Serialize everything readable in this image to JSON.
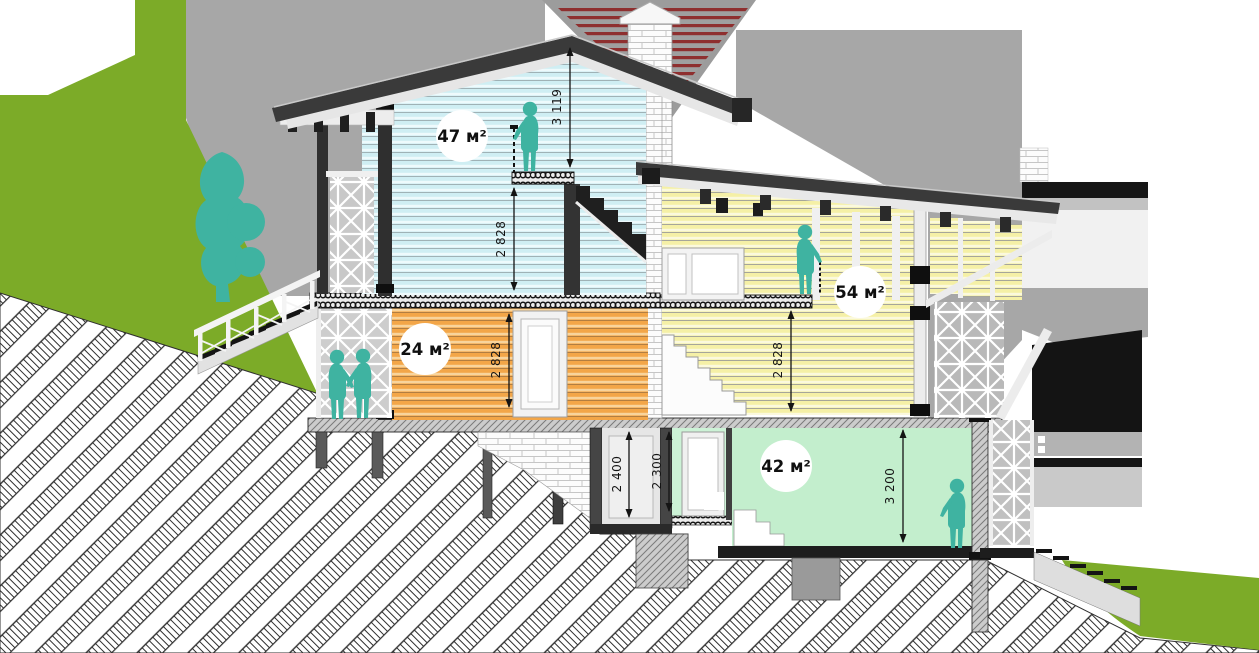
{
  "drawing": {
    "type": "house-cross-section",
    "rooms": [
      {
        "id": "attic",
        "area_label": "47 м²",
        "siding": "#cfeef3"
      },
      {
        "id": "middle-left",
        "area_label": "24 м²",
        "siding": "#f3a648"
      },
      {
        "id": "middle-right",
        "area_label": "54 м²",
        "siding": "#f5f0a6"
      },
      {
        "id": "basement",
        "area_label": "42 м²",
        "fill": "#c3eecd"
      }
    ],
    "dimensions": [
      {
        "id": "ridge-height",
        "value": "3 119"
      },
      {
        "id": "attic-ceiling",
        "value": "2 828"
      },
      {
        "id": "middle-left-ceiling",
        "value": "2 828"
      },
      {
        "id": "middle-right-ceiling",
        "value": "2 828"
      },
      {
        "id": "shaft-height",
        "value": "2 400"
      },
      {
        "id": "corridor-height",
        "value": "2 300"
      },
      {
        "id": "basement-ceiling",
        "value": "3 200"
      }
    ],
    "colors": {
      "slope_green": "#7cab28",
      "figure_teal": "#3fb3a1",
      "roof_dark": "#3a3a3a",
      "ground_hatch": "#2f2f2f",
      "basement_green": "#c3eecd",
      "corridor_green": "#ccf2d6",
      "background_gray": "#a7a7a7",
      "neighbor_roof_red": "#8e2f2f"
    }
  }
}
